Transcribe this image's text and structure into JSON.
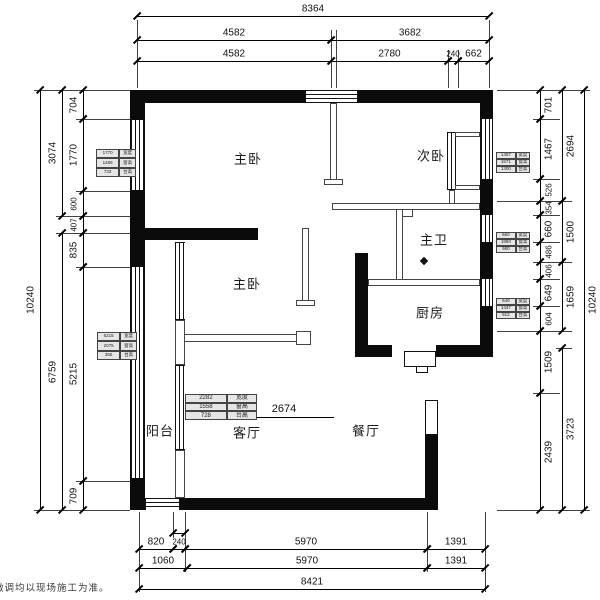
{
  "watermark": "微调均以现场施工为准。",
  "rooms": {
    "master_bedroom_top": "主卧",
    "second_bedroom": "次卧",
    "master_bath": "主卫",
    "master_bedroom_mid": "主卧",
    "kitchen": "厨房",
    "balcony": "阳台",
    "living_room": "客厅",
    "dining_room": "餐厅"
  },
  "annotations": {
    "opening_width": "2674"
  },
  "dimensions": {
    "top": {
      "row1": [
        "8364"
      ],
      "row2": [
        "4582",
        "3682"
      ],
      "row3": [
        "4582",
        "2780",
        "240",
        "662"
      ]
    },
    "bottom": {
      "row1": [
        "820",
        "240",
        "5970",
        "1391"
      ],
      "row2": [
        "1060",
        "5970",
        "1391"
      ],
      "row3": [
        "8421"
      ]
    },
    "left": {
      "inner": [
        "704",
        "1770",
        "600",
        "407",
        "835",
        "5215",
        "709"
      ],
      "mid": [
        "3074",
        "6759"
      ],
      "outer": [
        "10240"
      ]
    },
    "right": {
      "inner": [
        "701",
        "1467",
        "526",
        "354",
        "660",
        "486",
        "406",
        "649",
        "604",
        "1509",
        "2439"
      ],
      "mid": [
        "2694",
        "1500",
        "1659",
        "3723"
      ],
      "outer": [
        "10240"
      ]
    }
  },
  "window_tags": {
    "left_top": [
      [
        "1770",
        "宽度"
      ],
      [
        "1456",
        "窗高"
      ],
      [
        "733",
        "台高"
      ]
    ],
    "right_top": [
      [
        "1467",
        "宽度"
      ],
      [
        "1571",
        "窗高"
      ],
      [
        "1300",
        "台高"
      ]
    ],
    "right_mid": [
      [
        "660",
        "宽度"
      ],
      [
        "1850",
        "窗高"
      ],
      [
        "980",
        "台高"
      ]
    ],
    "right_kitchen": [
      [
        "649",
        "宽度"
      ],
      [
        "1447",
        "窗高"
      ],
      [
        "912",
        "台高"
      ]
    ],
    "left_balcony": [
      [
        "5215",
        "宽度"
      ],
      [
        "2075",
        "窗高"
      ],
      [
        "365",
        "台高"
      ]
    ],
    "living_door": [
      [
        "2282",
        "宽度"
      ],
      [
        "1558",
        "窗高"
      ],
      [
        "728",
        "台高"
      ]
    ]
  }
}
